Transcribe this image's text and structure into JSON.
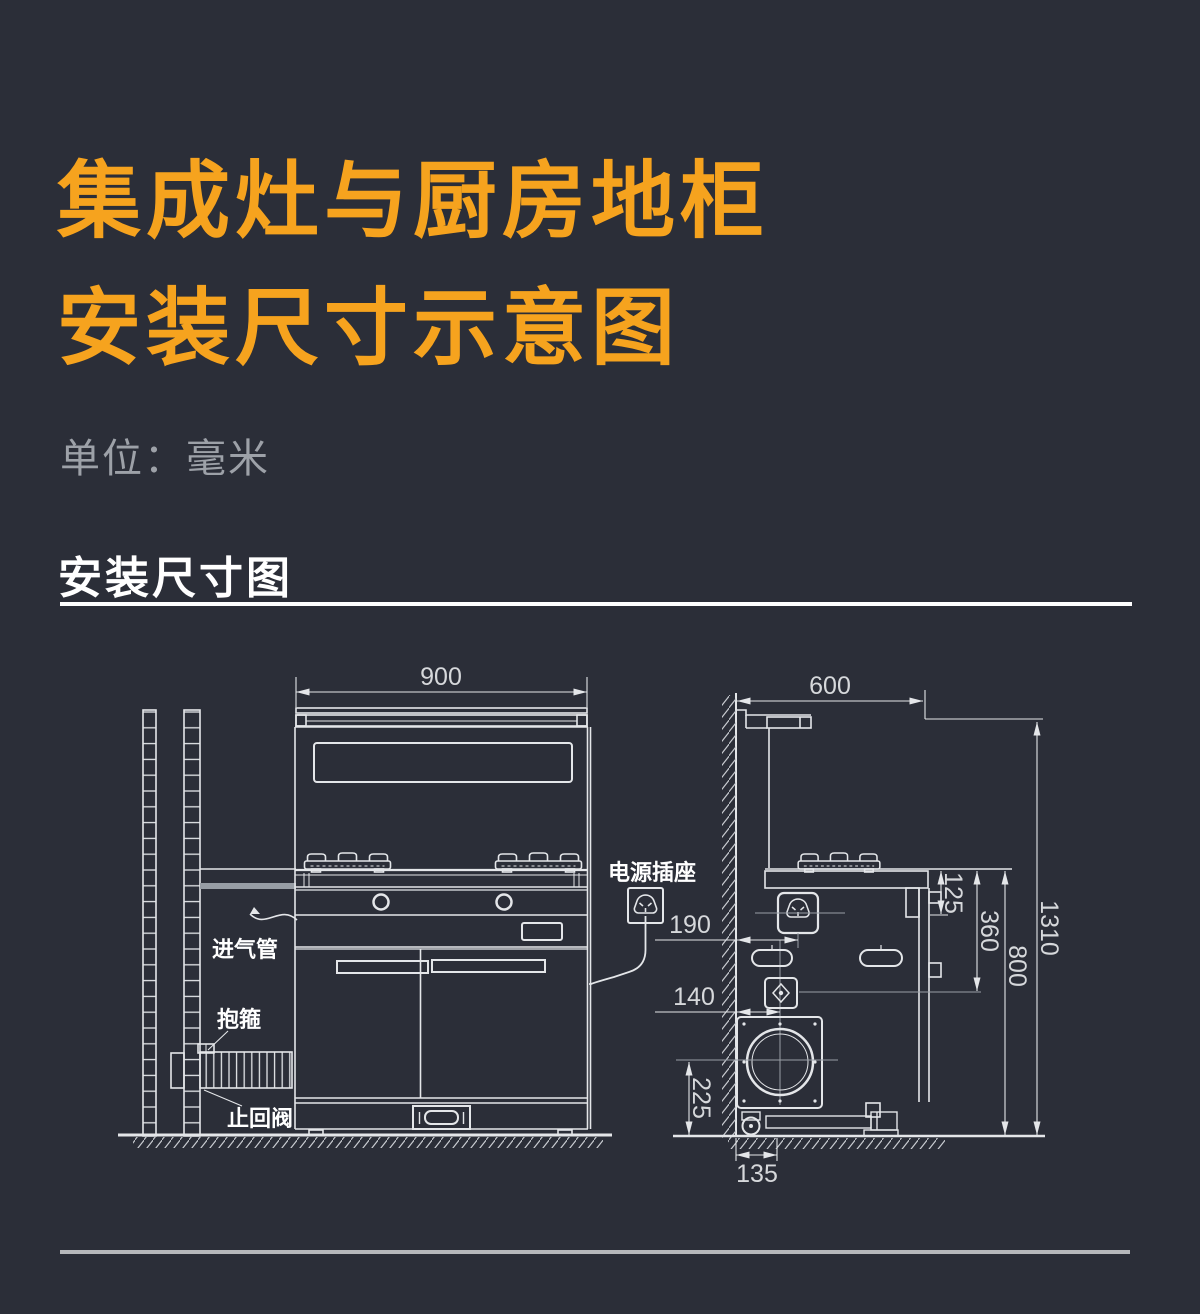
{
  "header": {
    "title_line1": "集成灶与厨房地柜",
    "title_line2": "安装尺寸示意图",
    "unit_note": "单位：毫米",
    "section_heading": "安装尺寸图"
  },
  "colors": {
    "background": "#2b2e38",
    "title_orange": "#f6a31e",
    "line_white": "#e4e6e9",
    "dim_text": "#d6d8db",
    "muted_gray": "#989ea6"
  },
  "front_view": {
    "width": "900",
    "label_power_socket": "电源插座",
    "label_gas_pipe": "进气管",
    "label_clamp": "抱箍",
    "label_check_valve": "止回阀"
  },
  "side_view": {
    "depth": "600",
    "socket_offset": "190",
    "inlet_offset": "140",
    "socket_drop": "125",
    "inlet_drop": "360",
    "counter_height": "800",
    "total_height": "1310",
    "outlet_height": "225",
    "outlet_offset": "135"
  }
}
